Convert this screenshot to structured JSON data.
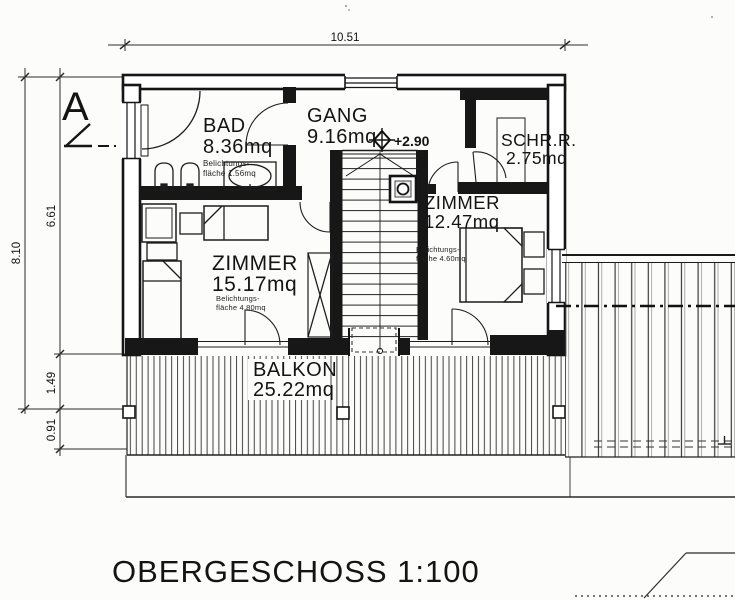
{
  "plan": {
    "title": "OBERGESCHOSS 1:100",
    "section_label": "A",
    "level_annotation": "+2.90",
    "dims": {
      "width_total": "10.51",
      "height_total": "8.10",
      "height_main": "6.61",
      "balcony_depth": "1.49",
      "overhang": "0.91"
    },
    "rooms": {
      "bad": {
        "name": "BAD",
        "area": "8.36mq",
        "light_note1": "Belichtungs-",
        "light_note2": "fläche 1.56mq"
      },
      "gang": {
        "name": "GANG",
        "area": "9.16mq"
      },
      "schrank": {
        "name": "SCHR.R.",
        "area": "2.75mq"
      },
      "zimmer1": {
        "name": "ZIMMER",
        "area": "12.47mq",
        "light_note1": "Belichtungs-",
        "light_note2": "fläche 4.60mq"
      },
      "zimmer2": {
        "name": "ZIMMER",
        "area": "15.17mq",
        "light_note1": "Belichtungs-",
        "light_note2": "fläche 4.80mq"
      },
      "balkon": {
        "name": "BALKON",
        "area": "25.22mq"
      }
    }
  }
}
